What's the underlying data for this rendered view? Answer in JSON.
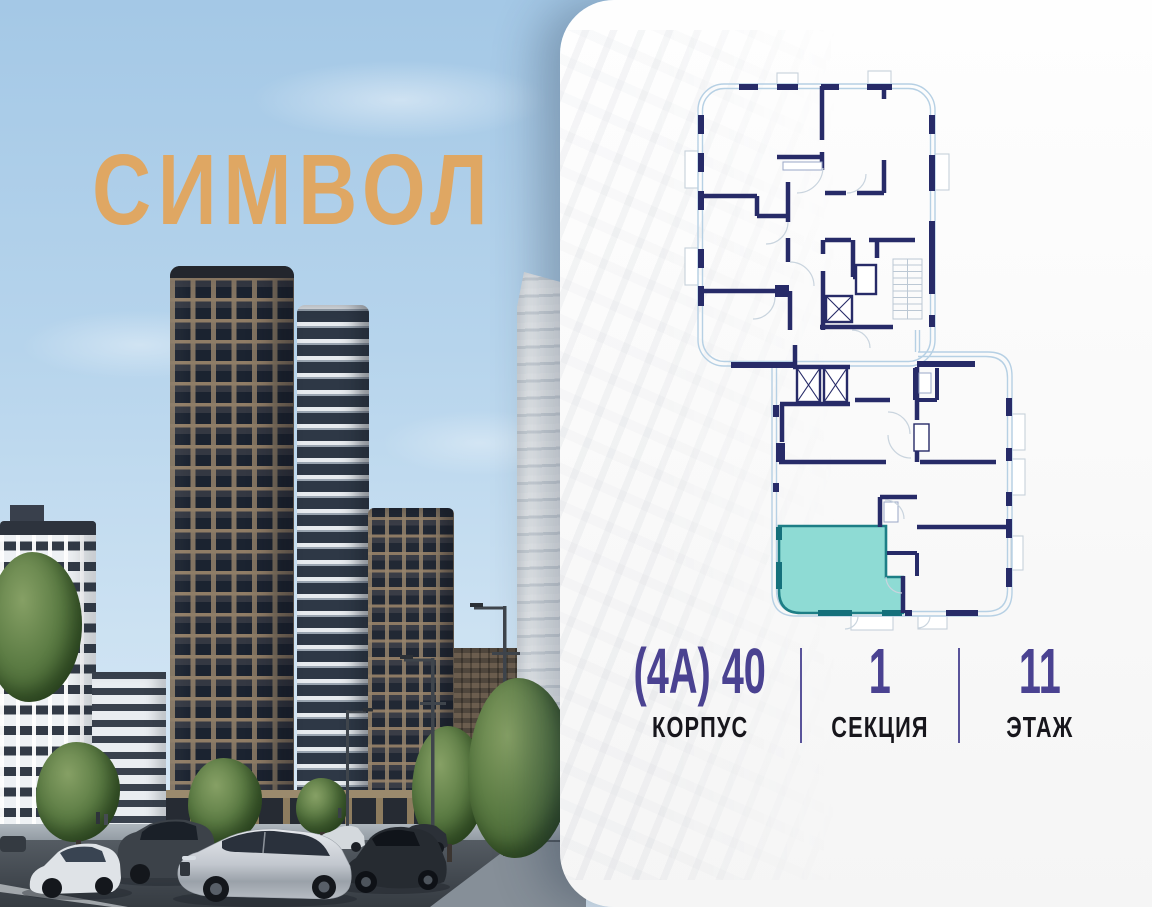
{
  "brand": {
    "logo_text": "СИМВОЛ"
  },
  "unit_info": {
    "columns": [
      {
        "value": "(4А) 40",
        "label": "КОРПУС"
      },
      {
        "value": "1",
        "label": "СЕКЦИЯ"
      },
      {
        "value": "11",
        "label": "ЭТАЖ"
      }
    ]
  },
  "floor_plan": {
    "description": "section floor plan with one highlighted apartment",
    "highlighted_unit_present": true
  },
  "colors": {
    "brand_gold": "#dfa763",
    "accent_purple": "#4a4291",
    "label_black": "#17161c",
    "divider_purple": "#59539a",
    "wall_navy": "#272b68",
    "plan_outline_blue": "#b6d0e4",
    "unit_fill_teal": "#8edbd4",
    "unit_stroke_teal": "#1d7e86",
    "unit_wall_teal": "#15707b",
    "sky_top": "#a4c8e6",
    "sky_bottom": "#dcebf7"
  }
}
